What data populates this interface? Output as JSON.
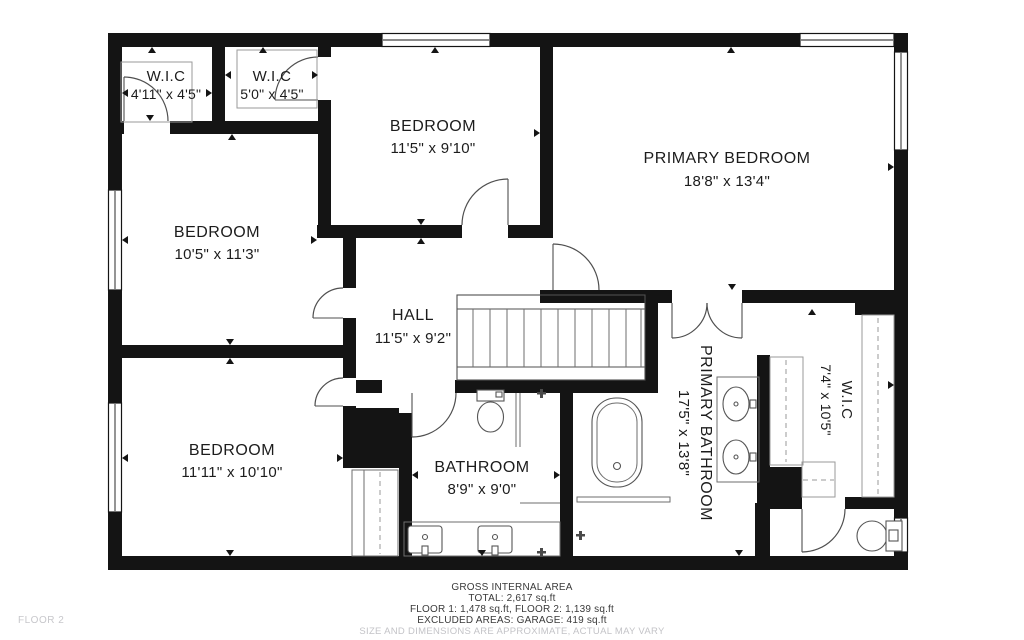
{
  "floor_label": "FLOOR 2",
  "rooms": [
    {
      "id": "wic-top-left-1",
      "name": "W.I.C",
      "dims": "4'11\" x 4'5\""
    },
    {
      "id": "wic-top-left-2",
      "name": "W.I.C",
      "dims": "5'0\" x 4'5\""
    },
    {
      "id": "bedroom-top",
      "name": "BEDROOM",
      "dims": "11'5\" x 9'10\""
    },
    {
      "id": "primary-bedroom",
      "name": "PRIMARY BEDROOM",
      "dims": "18'8\" x 13'4\""
    },
    {
      "id": "bedroom-left",
      "name": "BEDROOM",
      "dims": "10'5\" x 11'3\""
    },
    {
      "id": "hall",
      "name": "HALL",
      "dims": "11'5\" x 9'2\""
    },
    {
      "id": "bedroom-bottom",
      "name": "BEDROOM",
      "dims": "11'11\" x 10'10\""
    },
    {
      "id": "bathroom",
      "name": "BATHROOM",
      "dims": "8'9\" x 9'0\""
    },
    {
      "id": "primary-bathroom",
      "name": "PRIMARY BATHROOM",
      "dims": "17'5\" x 13'8\""
    },
    {
      "id": "wic-right",
      "name": "W.I.C",
      "dims": "7'4\" x 10'5\""
    }
  ],
  "footer": {
    "line1": "GROSS INTERNAL AREA",
    "line2": "TOTAL: 2,617 sq.ft",
    "line3": "FLOOR 1: 1,478 sq.ft, FLOOR 2: 1,139 sq.ft",
    "line4": "EXCLUDED AREAS: GARAGE: 419 sq.ft",
    "disclaimer": "SIZE AND DIMENSIONS ARE APPROXIMATE, ACTUAL MAY VARY"
  },
  "colors": {
    "wall": "#141414",
    "line": "#4f4f4f",
    "text": "#1c1c1c",
    "muted": "#c3c3c7",
    "background": "#ffffff"
  }
}
